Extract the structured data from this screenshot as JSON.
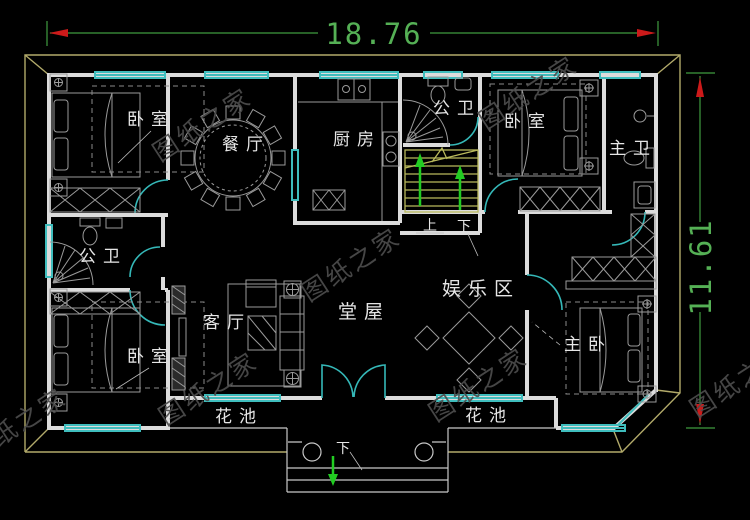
{
  "page": {
    "background": "#000000",
    "type": "architectural-floor-plan"
  },
  "dimensions": {
    "width_label": "18.76",
    "height_label": "11.61"
  },
  "rooms": {
    "bedroom_tl": "卧室",
    "dining": "餐厅",
    "kitchen": "厨房",
    "bath_top": "公卫",
    "bedroom_tr": "卧室",
    "master_bath": "主卫",
    "bath_left": "公卫",
    "living": "客厅",
    "hall": "堂屋",
    "entertainment": "娱乐区",
    "bedroom_bl": "卧室",
    "master_bedroom": "主卧",
    "flower_bed_left": "花池",
    "flower_bed_right": "花池"
  },
  "stairs": {
    "up_label": "上",
    "down_label": "下"
  },
  "entrance": {
    "down_label": "下"
  },
  "watermark": {
    "text": "图纸之家"
  },
  "colors": {
    "wall": "#dcdcdc",
    "window": "#3fbdbd",
    "dimension_line": "#3f9b3f",
    "dimension_arrow": "#cc1a1a",
    "eaves": "#b2aa6a",
    "stairs": "#b9b95c",
    "stair_arrow": "#22cc22",
    "furniture": "#9a9a9a",
    "label": "#e6e6e6",
    "watermark": "#4d4d4d"
  }
}
